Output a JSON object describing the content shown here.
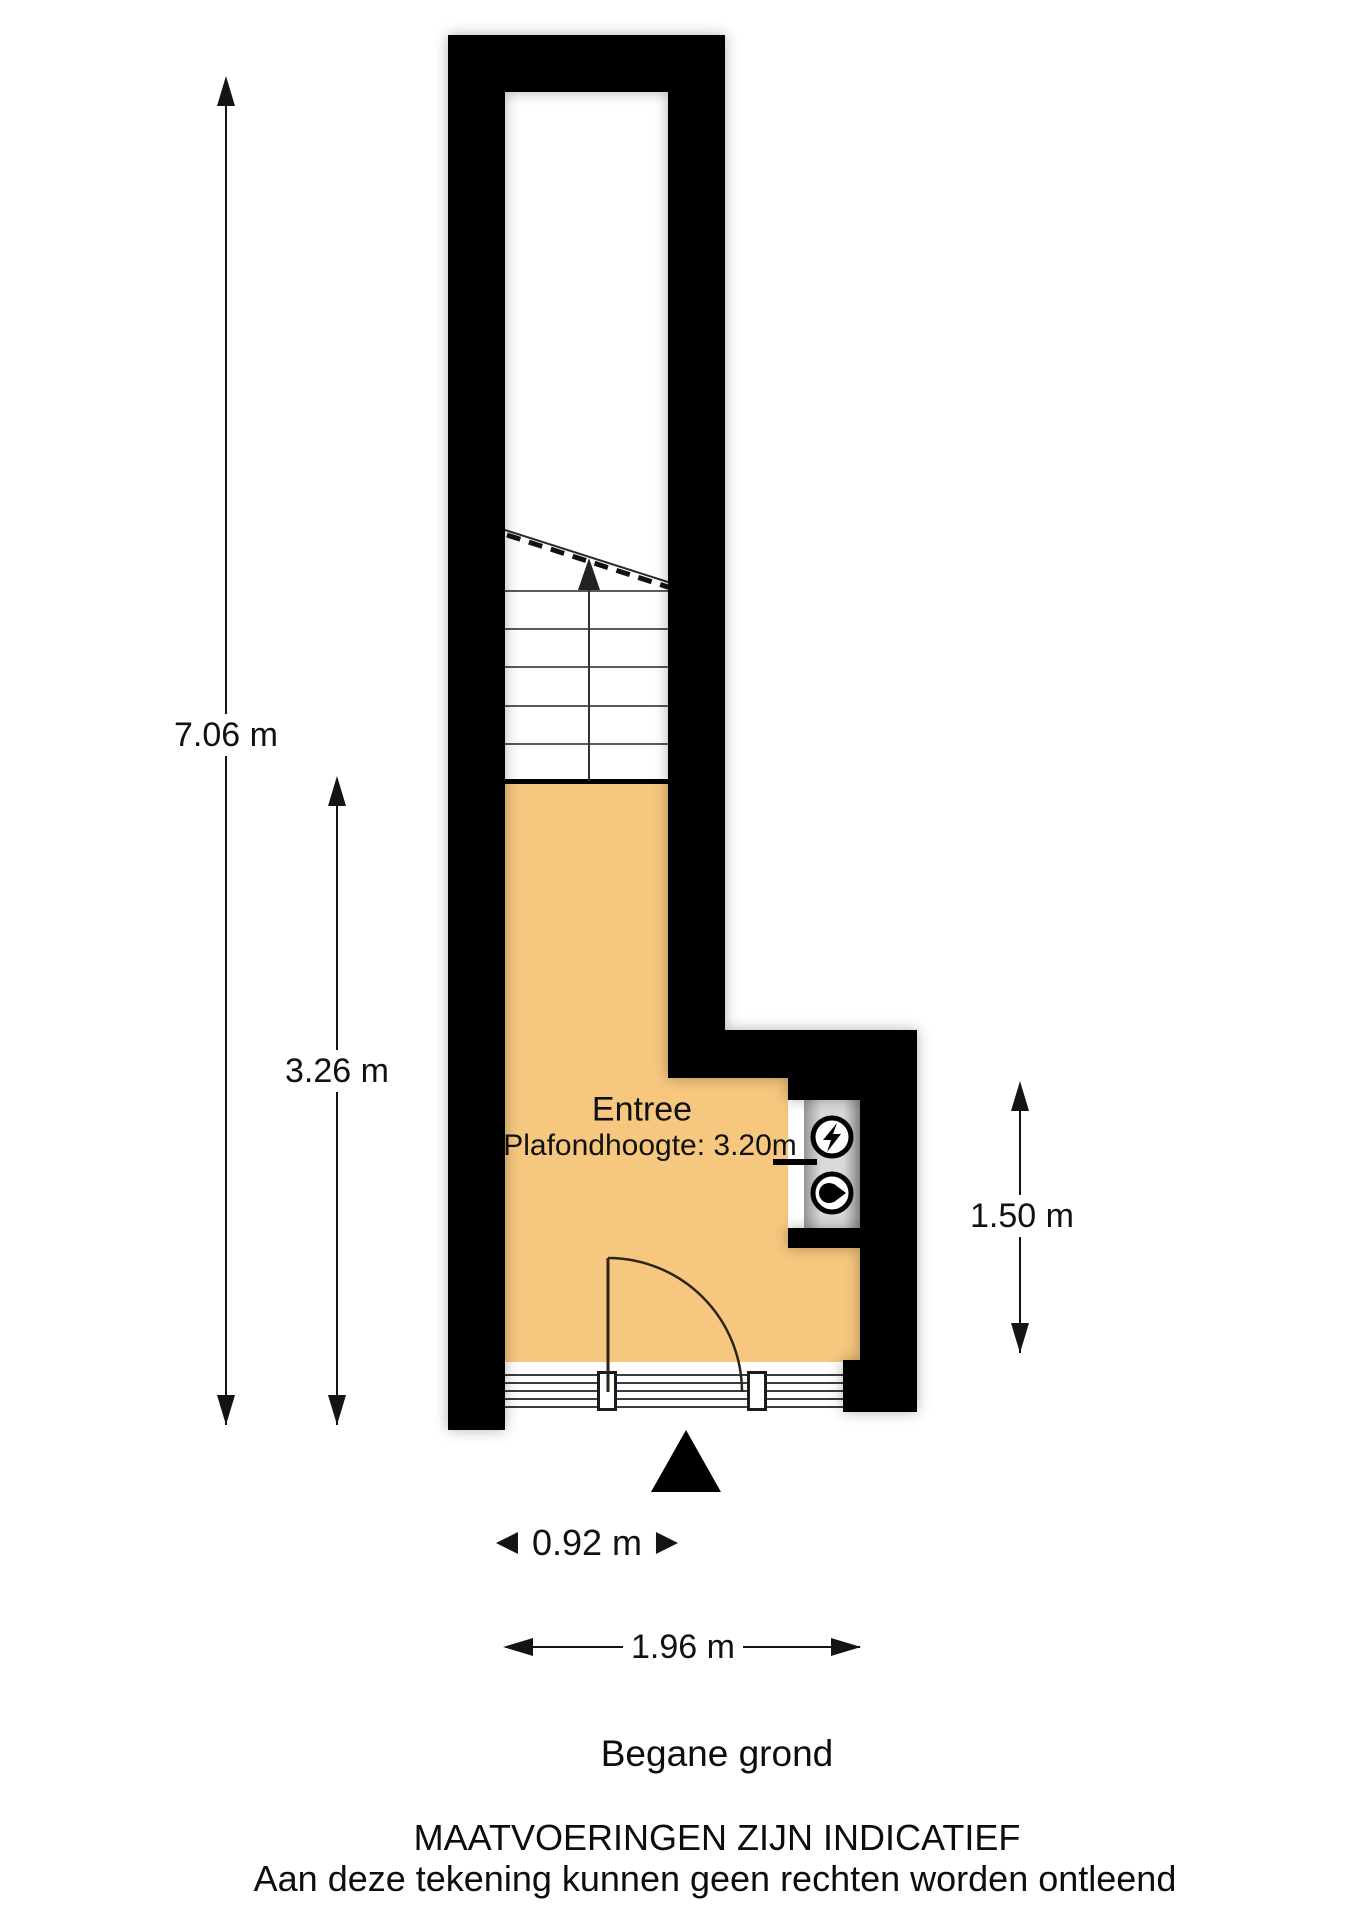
{
  "plan": {
    "room": {
      "name": "Entree",
      "ceiling_height": "Plafondhoogte: 3.20m"
    },
    "dimensions": {
      "total_height": "7.06 m",
      "entree_height": "3.26 m",
      "porch_depth": "1.50 m",
      "door_width": "0.92 m",
      "total_width": "1.96 m"
    },
    "icons": {
      "electricity_meter": "lightning-in-circle",
      "water_meter": "droplet-in-circle",
      "stairs_direction": "arrow-up",
      "entrance_marker": "black-triangle-up"
    },
    "colors": {
      "wall": "#000000",
      "floor": "#f6c77e",
      "background": "#ffffff",
      "cabinet_gray": "#c9c9c9"
    }
  },
  "footer": {
    "floor_label": "Begane grond",
    "disclaimer_line1": "MAATVOERINGEN ZIJN INDICATIEF",
    "disclaimer_line2": "Aan deze tekening kunnen geen rechten worden ontleend"
  }
}
